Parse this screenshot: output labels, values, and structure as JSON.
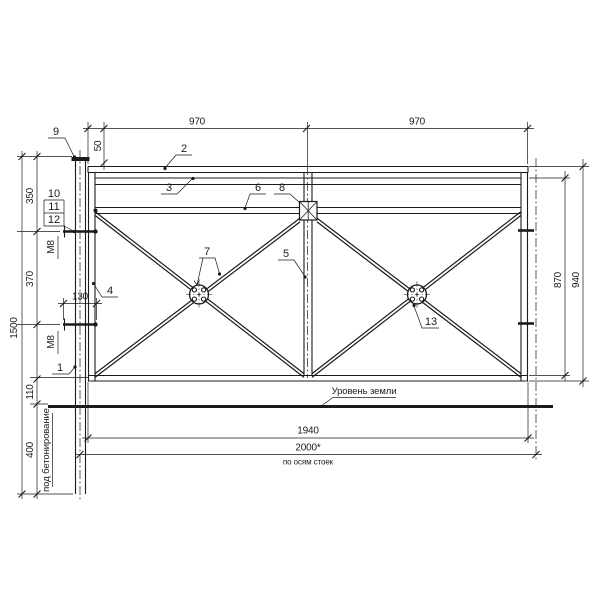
{
  "dims": {
    "span_left": "970",
    "span_right": "970",
    "rail_offset": "50",
    "top_to_bolt": "350",
    "bolt_to_bolt": "370",
    "bolt_length": "130",
    "post_length": "1500",
    "frame_to_ground": "110",
    "embed_depth": "400",
    "frame_height": "870",
    "panel_height": "940",
    "frame_width": "1940",
    "axis_span": "2000*",
    "axis_note": "по осям стоек"
  },
  "notes": {
    "ground_level": "Уровень земли",
    "concreting": "под бетонирование",
    "bolt_upper": "М8",
    "bolt_lower": "М8"
  },
  "callouts": {
    "c1": "1",
    "c2": "2",
    "c3": "3",
    "c4": "4",
    "c5": "5",
    "c6": "6",
    "c7": "7",
    "c8": "8",
    "c9": "9",
    "c10": "10",
    "c11": "11",
    "c12": "12",
    "c13": "13"
  },
  "colors": {
    "line": "#1b1b1b",
    "background": "#ffffff"
  }
}
